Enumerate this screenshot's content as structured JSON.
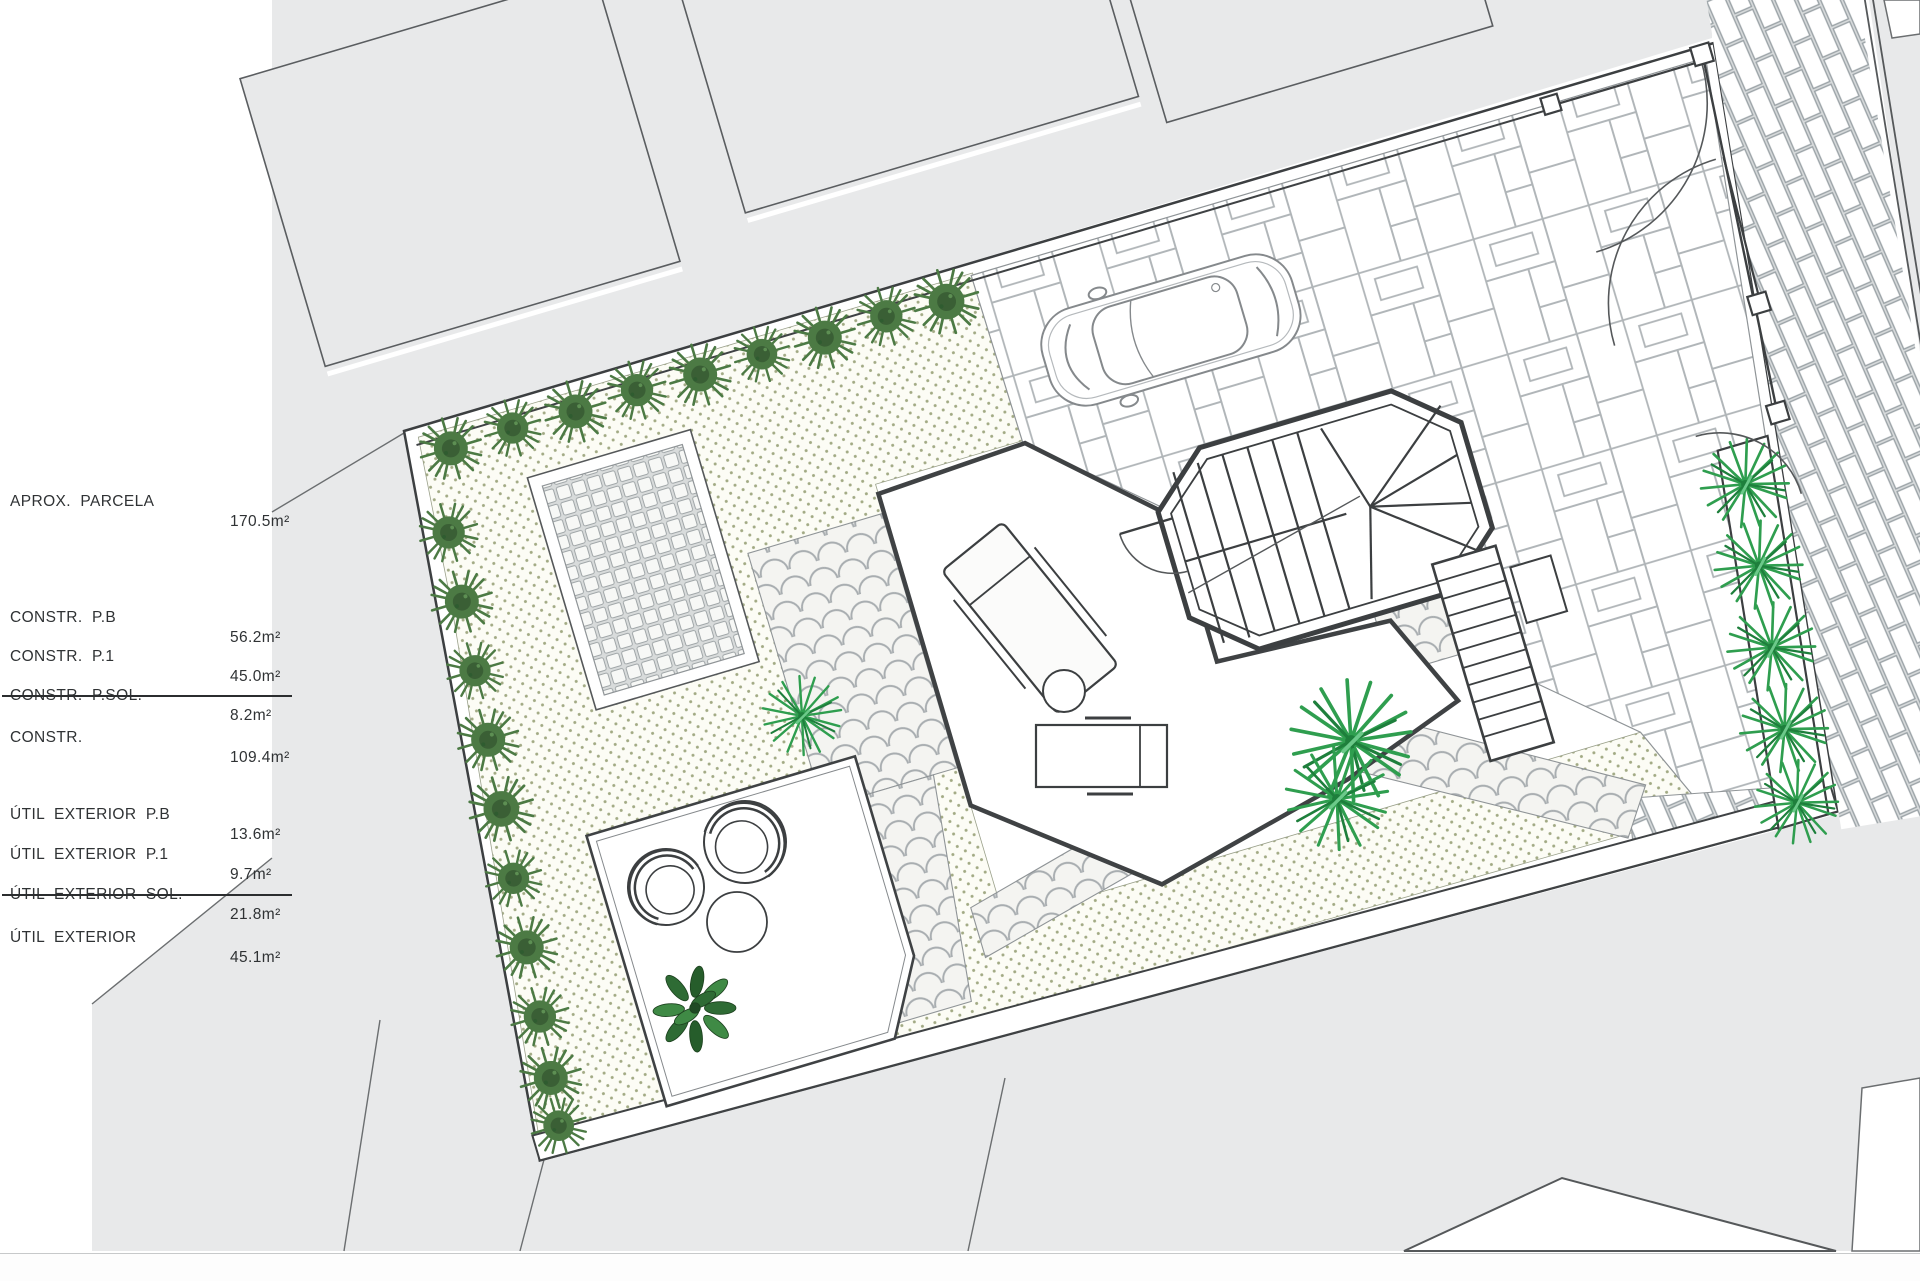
{
  "summary": {
    "rows": [
      {
        "label": "APROX.  PARCELA",
        "value": "170.5m²"
      },
      {
        "label": "CONSTR.  P.B",
        "value": "56.2m²"
      },
      {
        "label": "CONSTR.  P.1",
        "value": "45.0m²"
      },
      {
        "label": "CONSTR.  P.SOL.",
        "value": "8.2m²"
      },
      {
        "label": "CONSTR.",
        "value": "109.4m²"
      },
      {
        "label": "ÚTIL  EXTERIOR  P.B",
        "value": "13.6m²"
      },
      {
        "label": "ÚTIL  EXTERIOR  P.1",
        "value": "9.7m²"
      },
      {
        "label": "ÚTIL  EXTERIOR  SOL.",
        "value": "21.8m²"
      },
      {
        "label": "ÚTIL  EXTERIOR",
        "value": "45.1m²"
      }
    ]
  },
  "plan": {
    "colors": {
      "shrub_green": "#4c7a44",
      "shrub_dark": "#3a5f35",
      "palm_green": "#2f9e4f",
      "palm_dark": "#1e7f3c",
      "tree_green": "#2e6b34",
      "neighbor_gray": "#e8e9ea",
      "garden_cream": "#fcfcf5",
      "garden_dot": "#a2aa84",
      "line_dark": "#3c3f41",
      "line_paving": "#b2b7ba"
    },
    "icons": {
      "car": "car-top-view",
      "stair": "octagonal-staircase",
      "shrub": "shrub-icon",
      "palm": "palm-icon",
      "tree": "tree-icon"
    }
  }
}
